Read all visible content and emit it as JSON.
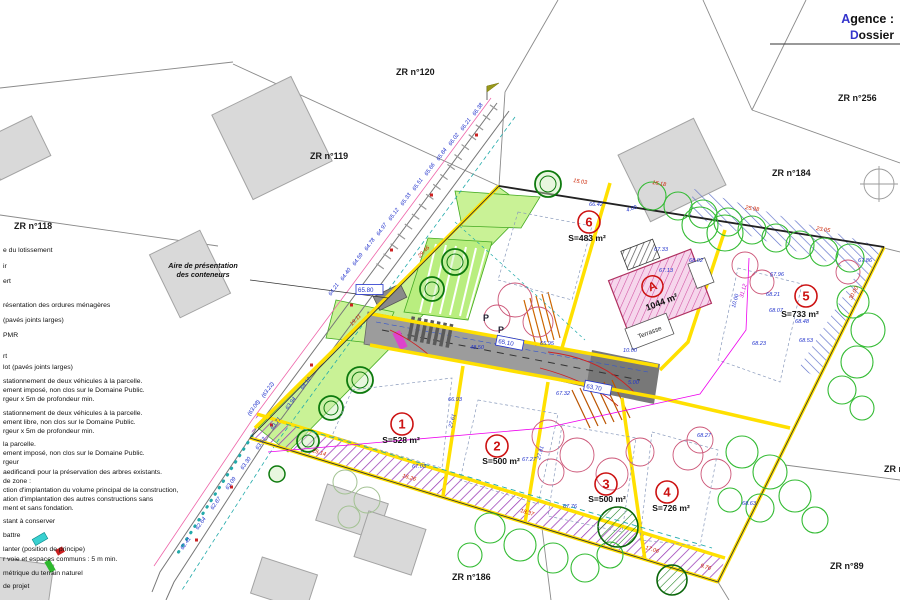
{
  "title_block": {
    "agence": "Agence :",
    "dossier": "Dossier"
  },
  "colors": {
    "accent_blue": "#3333cc",
    "dim_blue": "#2233cc",
    "dim_red": "#cc2200",
    "dim_magenta": "#cc00cc",
    "lot_red": "#cc1111",
    "boundary_yellow": "#ffe000",
    "green_area": "#c9f296"
  },
  "zr_labels": [
    {
      "t": "ZR n°118",
      "x": 14,
      "y": 229
    },
    {
      "t": "ZR n°119",
      "x": 310,
      "y": 159
    },
    {
      "t": "ZR n°120",
      "x": 396,
      "y": 75
    },
    {
      "t": "ZR n°256",
      "x": 838,
      "y": 101
    },
    {
      "t": "ZR n°184",
      "x": 772,
      "y": 176
    },
    {
      "t": "ZR n°44",
      "x": 884,
      "y": 472
    },
    {
      "t": "ZR n°89",
      "x": 830,
      "y": 569
    },
    {
      "t": "ZR n°186",
      "x": 452,
      "y": 580
    }
  ],
  "lots": [
    {
      "num": "1",
      "cx": 402,
      "cy": 424,
      "area": "S=528 m²",
      "ax": 401,
      "ay": 443
    },
    {
      "num": "2",
      "cx": 497,
      "cy": 446,
      "area": "S=500 m²",
      "ax": 501,
      "ay": 464
    },
    {
      "num": "3",
      "cx": 606,
      "cy": 484,
      "area": "S=500 m²",
      "ax": 607,
      "ay": 502
    },
    {
      "num": "4",
      "cx": 667,
      "cy": 492,
      "area": "S=726 m²",
      "ax": 671,
      "ay": 511
    },
    {
      "num": "5",
      "cx": 806,
      "cy": 296,
      "area": "S=733 m²",
      "ax": 800,
      "ay": 317
    },
    {
      "num": "6",
      "cx": 589,
      "cy": 222,
      "area": "S=483 m²",
      "ax": 587,
      "ay": 241
    }
  ],
  "parcel_a": {
    "label": "A",
    "area": "1044 m²",
    "terrasse": "Terrasse"
  },
  "p_labels": [
    {
      "t": "P",
      "x": 483,
      "y": 321
    },
    {
      "t": "P",
      "x": 498,
      "y": 333
    }
  ],
  "container_note": {
    "line1": "Aire de présentation",
    "line2": "des conteneurs",
    "x": 203,
    "y": 268
  },
  "boxed_levels": [
    {
      "t": "65.80",
      "x": 358,
      "y": 292,
      "r": 0
    },
    {
      "t": "65.10",
      "x": 498,
      "y": 343,
      "r": 11
    },
    {
      "t": "63.70",
      "x": 586,
      "y": 388,
      "r": 11
    }
  ],
  "dims": [
    {
      "t": "66.38",
      "x": 475,
      "y": 116,
      "r": -55
    },
    {
      "t": "66.21",
      "x": 463,
      "y": 131,
      "r": -55
    },
    {
      "t": "66.02",
      "x": 451,
      "y": 146,
      "r": -55
    },
    {
      "t": "65.84",
      "x": 439,
      "y": 161,
      "r": -55
    },
    {
      "t": "65.66",
      "x": 427,
      "y": 176,
      "r": -55
    },
    {
      "t": "65.51",
      "x": 415,
      "y": 191,
      "r": -55
    },
    {
      "t": "65.33",
      "x": 403,
      "y": 206,
      "r": -55
    },
    {
      "t": "65.12",
      "x": 391,
      "y": 221,
      "r": -55
    },
    {
      "t": "64.97",
      "x": 379,
      "y": 236,
      "r": -55
    },
    {
      "t": "64.78",
      "x": 367,
      "y": 251,
      "r": -55
    },
    {
      "t": "64.59",
      "x": 355,
      "y": 266,
      "r": -55
    },
    {
      "t": "64.40",
      "x": 343,
      "y": 281,
      "r": -55
    },
    {
      "t": "64.21",
      "x": 331,
      "y": 296,
      "r": -55
    },
    {
      "t": "64.12",
      "x": 303,
      "y": 390,
      "r": -55
    },
    {
      "t": "63.94",
      "x": 288,
      "y": 410,
      "r": -55
    },
    {
      "t": "63.71",
      "x": 273,
      "y": 430,
      "r": -55
    },
    {
      "t": "63.52",
      "x": 258,
      "y": 450,
      "r": -55
    },
    {
      "t": "63.30",
      "x": 243,
      "y": 470,
      "r": -55
    },
    {
      "t": "63.09",
      "x": 228,
      "y": 490,
      "r": -55
    },
    {
      "t": "62.87",
      "x": 213,
      "y": 510,
      "r": -55
    },
    {
      "t": "62.64",
      "x": 198,
      "y": 530,
      "r": -55
    },
    {
      "t": "62.41",
      "x": 183,
      "y": 550,
      "r": -55
    },
    {
      "t": "(63.22)",
      "x": 264,
      "y": 398,
      "r": -55
    },
    {
      "t": "(63.08)",
      "x": 250,
      "y": 416,
      "r": -55
    },
    {
      "t": "66.93",
      "x": 448,
      "y": 401
    },
    {
      "t": "67.03",
      "x": 412,
      "y": 468
    },
    {
      "t": "67.32",
      "x": 556,
      "y": 395
    },
    {
      "t": "67.27",
      "x": 522,
      "y": 461
    },
    {
      "t": "67.76",
      "x": 563,
      "y": 508
    },
    {
      "t": "68.27",
      "x": 697,
      "y": 437
    },
    {
      "t": "68.63",
      "x": 742,
      "y": 505
    },
    {
      "t": "67.96",
      "x": 770,
      "y": 276
    },
    {
      "t": "68.21",
      "x": 766,
      "y": 296
    },
    {
      "t": "68.07",
      "x": 769,
      "y": 312
    },
    {
      "t": "68.48",
      "x": 795,
      "y": 323
    },
    {
      "t": "68.53",
      "x": 799,
      "y": 342
    },
    {
      "t": "68.23",
      "x": 752,
      "y": 345
    },
    {
      "t": "67.86",
      "x": 858,
      "y": 262
    },
    {
      "t": "66.42",
      "x": 589,
      "y": 206
    },
    {
      "t": "67.33",
      "x": 654,
      "y": 251
    },
    {
      "t": "67.13",
      "x": 659,
      "y": 272
    },
    {
      "t": "68.02",
      "x": 689,
      "y": 262
    },
    {
      "t": "48.50",
      "x": 470,
      "y": 349
    },
    {
      "t": "10.00",
      "x": 623,
      "y": 352
    },
    {
      "t": "5.00",
      "x": 628,
      "y": 384
    },
    {
      "t": "4.00",
      "x": 627,
      "y": 212,
      "r": -20
    },
    {
      "t": "65.95",
      "x": 540,
      "y": 345
    },
    {
      "t": "10.00",
      "x": 735,
      "y": 308,
      "r": -75
    },
    {
      "t": "27.61",
      "x": 452,
      "y": 428,
      "r": -75
    },
    {
      "t": "27.81",
      "x": 540,
      "y": 460,
      "r": -75
    },
    {
      "t": "15.03",
      "x": 573,
      "y": 182,
      "r": 9,
      "c": "r"
    },
    {
      "t": "16.18",
      "x": 652,
      "y": 184,
      "r": 9,
      "c": "r"
    },
    {
      "t": "25.98",
      "x": 745,
      "y": 209,
      "r": 9,
      "c": "r"
    },
    {
      "t": "23.05",
      "x": 816,
      "y": 230,
      "r": 9,
      "c": "r"
    },
    {
      "t": "25.14",
      "x": 312,
      "y": 452,
      "r": 17,
      "c": "r"
    },
    {
      "t": "16.26",
      "x": 402,
      "y": 477,
      "r": 17,
      "c": "r"
    },
    {
      "t": "18.37",
      "x": 520,
      "y": 512,
      "r": 17,
      "c": "r"
    },
    {
      "t": "17.06",
      "x": 645,
      "y": 549,
      "r": 17,
      "c": "r"
    },
    {
      "t": "9.76",
      "x": 700,
      "y": 567,
      "r": 17,
      "c": "r"
    },
    {
      "t": "29.46",
      "x": 420,
      "y": 258,
      "r": -46,
      "c": "r"
    },
    {
      "t": "19.11",
      "x": 352,
      "y": 326,
      "r": -46,
      "c": "r"
    },
    {
      "t": "30.00",
      "x": 852,
      "y": 300,
      "r": -63,
      "c": "r"
    },
    {
      "t": "31.12",
      "x": 743,
      "y": 298,
      "r": -75,
      "c": "m"
    }
  ],
  "legend_lines": [
    {
      "y": 252,
      "t": "e du lotissement"
    },
    {
      "y": 268,
      "t": "ir"
    },
    {
      "y": 283,
      "t": "ert"
    },
    {
      "y": 307,
      "t": "résentation des ordures ménagères"
    },
    {
      "y": 322,
      "t": "(pavés joints larges)"
    },
    {
      "y": 337,
      "t": "PMR"
    },
    {
      "y": 358,
      "t": "rt"
    },
    {
      "y": 369,
      "t": "lot (pavés joints larges)"
    },
    {
      "y": 383,
      "t": "stationnement de deux véhicules à la parcelle."
    },
    {
      "y": 392,
      "t": "ement imposé, non clos sur le Domaine Public."
    },
    {
      "y": 401,
      "t": "rgeur x 5m de profondeur min."
    },
    {
      "y": 415,
      "t": "stationnement de deux véhicules à la parcelle."
    },
    {
      "y": 424,
      "t": "ement libre, non clos sur le Domaine Public."
    },
    {
      "y": 433,
      "t": "rgeur x 5m de profondeur min."
    },
    {
      "y": 446,
      "t": "la parcelle."
    },
    {
      "y": 455,
      "t": "ement imposé, non clos sur le Domaine Public."
    },
    {
      "y": 464,
      "t": "rgeur"
    },
    {
      "y": 474,
      "t": "aedificandi pour la préservation des arbres existants."
    },
    {
      "y": 483,
      "t": "de zone :"
    },
    {
      "y": 492,
      "t": "ction d'implantation du volume principal de la construction,"
    },
    {
      "y": 501,
      "t": "ation d'implantation des autres constructions sans"
    },
    {
      "y": 510,
      "t": "ment et sans fondation."
    },
    {
      "y": 523,
      "t": "stant à conserver"
    },
    {
      "y": 537,
      "t": "battre"
    },
    {
      "y": 551,
      "t": "lanter (position de principe)"
    },
    {
      "y": 561,
      "t": "r voie et espaces communs : 5 m min."
    },
    {
      "y": 575,
      "t": "métrique du terrain naturel"
    },
    {
      "y": 588,
      "t": "de projet"
    }
  ]
}
